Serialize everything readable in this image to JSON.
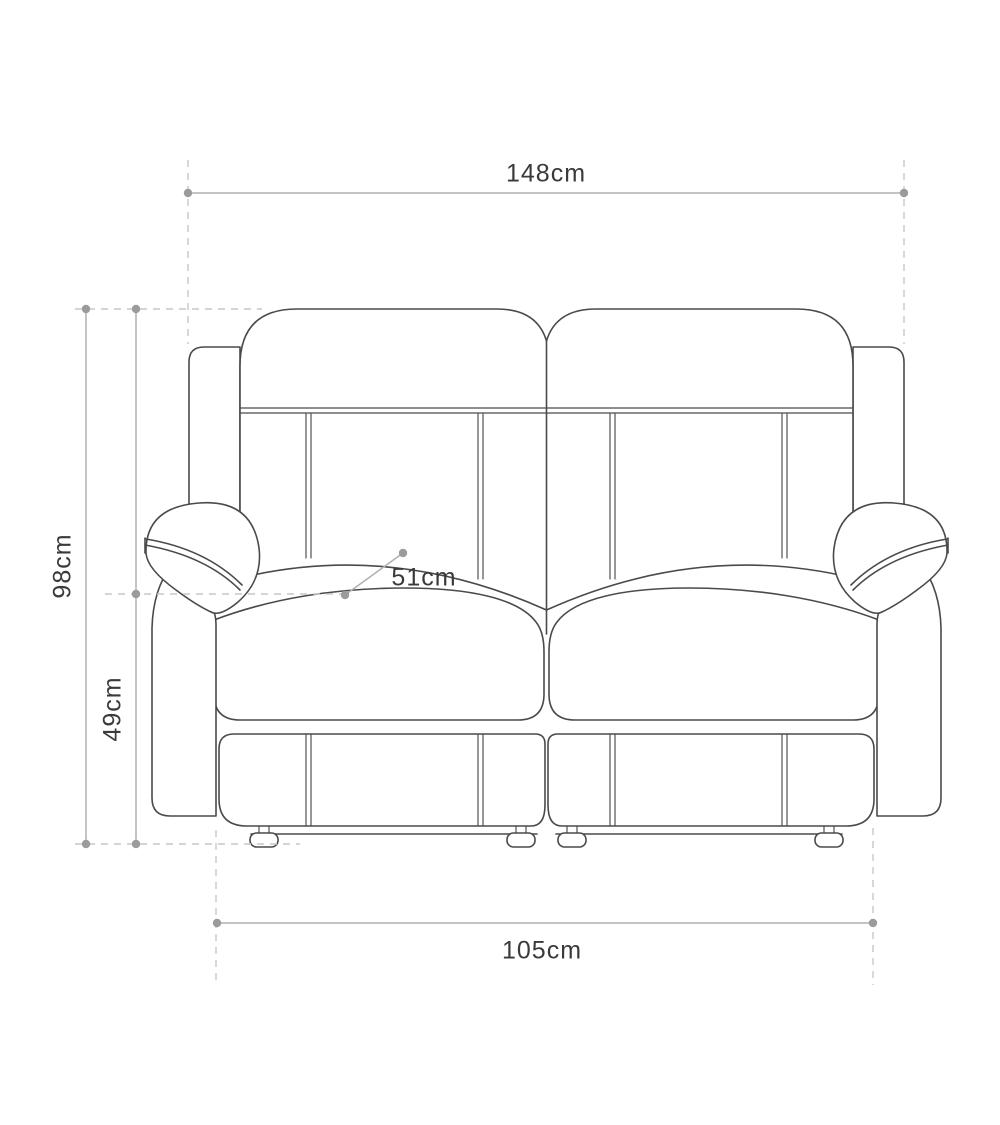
{
  "diagram": {
    "labels": {
      "overall_width": "148cm",
      "overall_height": "98cm",
      "seat_height": "49cm",
      "seat_depth": "51cm",
      "base_width": "105cm"
    },
    "colors": {
      "outline": "#4a4a4a",
      "dimension_line": "#b0b0b0",
      "dashed_line": "#c7c7c7",
      "dot": "#9b9b9b",
      "label_text": "#3a3a3a",
      "background": "#ffffff"
    }
  }
}
